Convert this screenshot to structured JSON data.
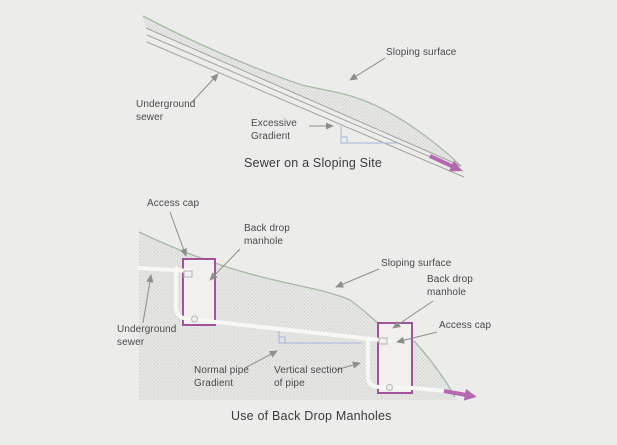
{
  "top": {
    "title": "Sewer on a Sloping Site",
    "labels": {
      "sloping_surface": "Sloping surface",
      "underground_sewer": "Underground\nsewer",
      "excessive_gradient": "Excessive\nGradient"
    }
  },
  "bottom": {
    "title": "Use of Back Drop Manholes",
    "labels": {
      "access_cap_left": "Access cap",
      "back_drop_manhole_left": "Back drop\nmanhole",
      "sloping_surface": "Sloping surface",
      "back_drop_manhole_right": "Back drop\nmanhole",
      "access_cap_right": "Access cap",
      "underground_sewer": "Underground\nsewer",
      "normal_pipe_gradient": "Normal pipe\nGradient",
      "vertical_section_of_pipe": "Vertical section\nof pipe"
    }
  },
  "colors": {
    "background": "#ececeb",
    "hatch_fill": "#e9e9e7",
    "hatch_line": "#cdcdcb",
    "surface_green": "#a6bca2",
    "pipe_gray": "#a3a3a1",
    "pipe_white": "#f7f7f6",
    "leader_gray": "#8d8d8b",
    "gradient_blue": "#a3b6d0",
    "manhole_purple": "#a1539b",
    "manhole_fill": "#f1f0ef",
    "flow_arrow_pink": "#b468b0",
    "label_text": "#4a4a4a",
    "title_text": "#3b3b3b"
  }
}
